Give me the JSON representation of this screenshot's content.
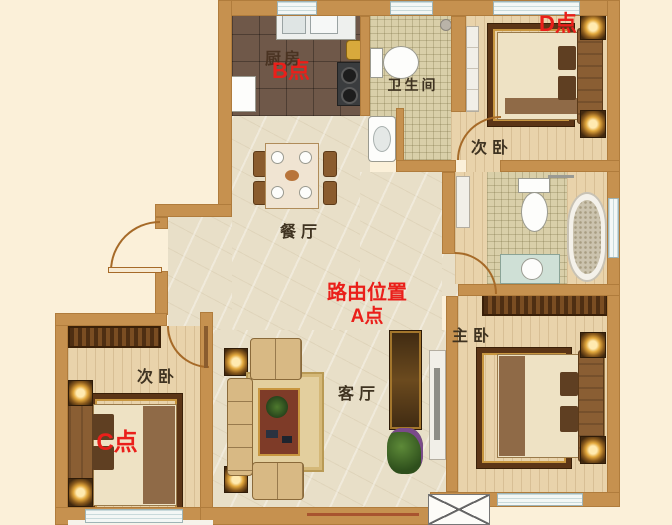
{
  "annotations": {
    "red_color": "#ea1f1a",
    "point_a": {
      "line1": "路由位置",
      "line2": "A点"
    },
    "point_b": {
      "label": "B点"
    },
    "point_c": {
      "label": "C点"
    },
    "point_d": {
      "label": "D点"
    }
  },
  "rooms": {
    "kitchen": {
      "label": "厨房"
    },
    "bathroom": {
      "label": "卫生间"
    },
    "bedroom_top_right": {
      "label": "次卧"
    },
    "bedroom_bottom_left": {
      "label": "次卧"
    },
    "dining_room": {
      "label": "餐厅"
    },
    "living_room": {
      "label": "客厅"
    },
    "master_bedroom": {
      "label": "主卧"
    }
  },
  "palette": {
    "background": "#fbf0d9",
    "wall": "#c6914f",
    "marble_floor": "#e8dfc8",
    "wood_floor": "#e9d3ab",
    "kitchen_tile": "#6f5849",
    "mosaic_tile": "#d9cfa9",
    "window": "#f3f7f5"
  }
}
